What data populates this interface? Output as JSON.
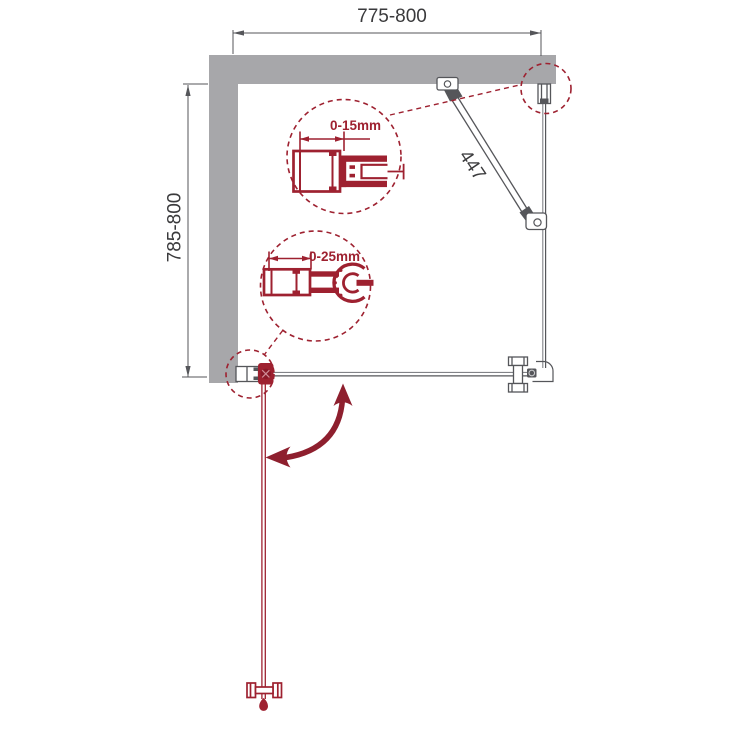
{
  "diagram": {
    "type": "shower-enclosure-installation-plan",
    "dimensions": {
      "top_width_mm": "775-800",
      "side_depth_mm": "785-800",
      "support_strut_mm": "447",
      "wall_profile_adjustment": "0-15mm",
      "hinge_profile_adjustment": "0-25mm"
    },
    "colors": {
      "wall_gray": "#a7a7aa",
      "drawing_line": "#55565a",
      "drawing_line_light": "#828388",
      "dimension_text": "#3a3a3c",
      "accent_red": "#9e2130",
      "swing_arrow_red": "#8e1f2e"
    },
    "parts": [
      "top-wall",
      "left-wall",
      "top-width-dimension",
      "side-depth-dimension",
      "fixed-side-panel",
      "wall-mount-profile",
      "support-strut",
      "strut-wall-bracket",
      "strut-glass-clamp",
      "door-closed-position",
      "door-open-position",
      "door-wall-profile",
      "door-pivot-hinge",
      "door-handle",
      "corner-connector",
      "door-swing-arrow",
      "detail-wall-profile-0-15mm",
      "detail-hinge-profile-0-25mm"
    ]
  }
}
